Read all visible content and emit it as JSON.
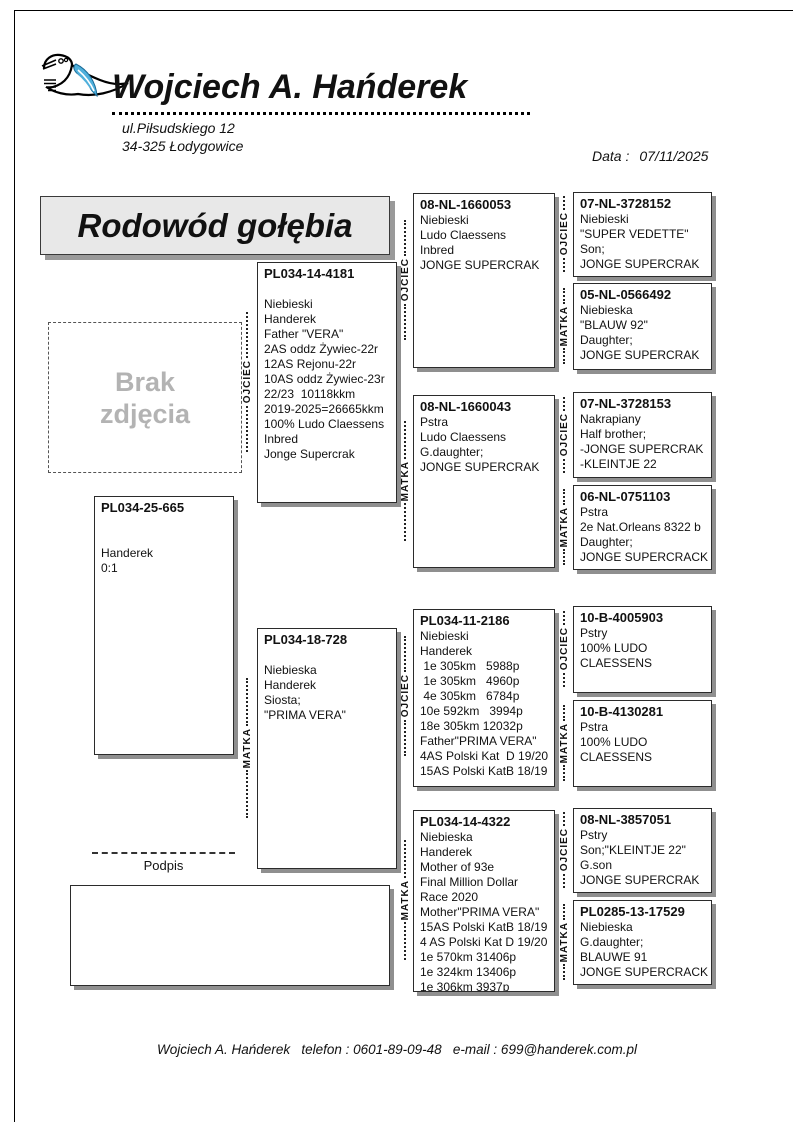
{
  "owner": {
    "name": "Wojciech A. Hańderek",
    "address_line1": "ul.Piłsudskiego 12",
    "address_line2": "34-325 Łodygowice"
  },
  "header": {
    "logo_icon": "pigeon-logo",
    "date_label": "Data :",
    "date_value": "07/11/2025"
  },
  "title": "Rodowód gołębia",
  "photo_placeholder": {
    "line1": "Brak",
    "line2": "zdjęcia"
  },
  "labels": {
    "father": "OJCIEC",
    "mother": "MATKA",
    "signature": "Podpis"
  },
  "footer": "Wojciech A. Hańderek   telefon : 0601-89-09-48   e-mail : 699@handerek.com.pl",
  "colors": {
    "accent_blue": "#4fb0dc",
    "title_bg": "#e8e8e8",
    "box_shadow": "#8f8f8f",
    "muted_text": "#b3b3b3"
  },
  "pedigree": {
    "subject": {
      "id": "PL034-25-665",
      "lines": [
        "",
        "",
        "Handerek",
        "0:1"
      ]
    },
    "father": {
      "id": "PL034-14-4181",
      "lines": [
        "",
        "Niebieski",
        "Handerek",
        "Father \"VERA\"",
        "2AS oddz Żywiec-22r",
        "12AS Rejonu-22r",
        "10AS oddz Żywiec-23r",
        "22/23  10118kkm",
        "2019-2025=26665kkm",
        "100% Ludo Claessens",
        "Inbred",
        "Jonge Supercrak"
      ]
    },
    "mother": {
      "id": "PL034-18-728",
      "lines": [
        "",
        "Niebieska",
        "Handerek",
        "Siosta;",
        "\"PRIMA VERA\""
      ]
    },
    "ff": {
      "id": "08-NL-1660053",
      "lines": [
        "Niebieski",
        "Ludo Claessens",
        "Inbred",
        "JONGE SUPERCRAK"
      ]
    },
    "fm": {
      "id": "08-NL-1660043",
      "lines": [
        "Pstra",
        "Ludo Claessens",
        "G.daughter;",
        "JONGE SUPERCRAK"
      ]
    },
    "mf": {
      "id": "PL034-11-2186",
      "lines": [
        "Niebieski",
        "Handerek",
        " 1e 305km   5988p",
        " 1e 305km   4960p",
        " 4e 305km   6784p",
        "10e 592km   3994p",
        "18e 305km 12032p",
        "Father\"PRIMA VERA\"",
        "4AS Polski Kat  D 19/20",
        "15AS Polski KatB 18/19"
      ]
    },
    "mm": {
      "id": "PL034-14-4322",
      "lines": [
        "Niebieska",
        "Handerek",
        "Mother of 93e",
        "Final Million Dollar",
        "Race 2020",
        "Mother\"PRIMA VERA\"",
        "15AS Polski KatB 18/19",
        "4 AS Polski Kat D 19/20",
        "1e 570km 31406p",
        "1e 324km 13406p",
        "1e 306km 3937p"
      ]
    },
    "fff": {
      "id": "07-NL-3728152",
      "lines": [
        "Niebieski",
        "\"SUPER VEDETTE\"",
        "Son;",
        "JONGE SUPERCRAK"
      ]
    },
    "ffm": {
      "id": "05-NL-0566492",
      "lines": [
        "Niebieska",
        "\"BLAUW 92\"",
        "Daughter;",
        "JONGE SUPERCRAK"
      ]
    },
    "fmf": {
      "id": "07-NL-3728153",
      "lines": [
        "Nakrapiany",
        "Half brother;",
        "-JONGE SUPERCRAK",
        "-KLEINTJE 22"
      ]
    },
    "fmm": {
      "id": "06-NL-0751103",
      "lines": [
        "Pstra",
        "2e Nat.Orleans 8322 b",
        "Daughter;",
        "JONGE SUPERCRACK"
      ]
    },
    "mff": {
      "id": "10-B-4005903",
      "lines": [
        "Pstry",
        "100% LUDO",
        "CLAESSENS"
      ]
    },
    "mfm": {
      "id": "10-B-4130281",
      "lines": [
        "Pstra",
        "100% LUDO",
        "CLAESSENS"
      ]
    },
    "mmf": {
      "id": "08-NL-3857051",
      "lines": [
        "Pstry",
        "Son;\"KLEINTJE 22\"",
        "G.son",
        "JONGE SUPERCRAK"
      ]
    },
    "mmm": {
      "id": "PL0285-13-17529",
      "lines": [
        "Niebieska",
        "G.daughter;",
        "BLAUWE 91",
        "JONGE SUPERCRACK"
      ]
    }
  }
}
